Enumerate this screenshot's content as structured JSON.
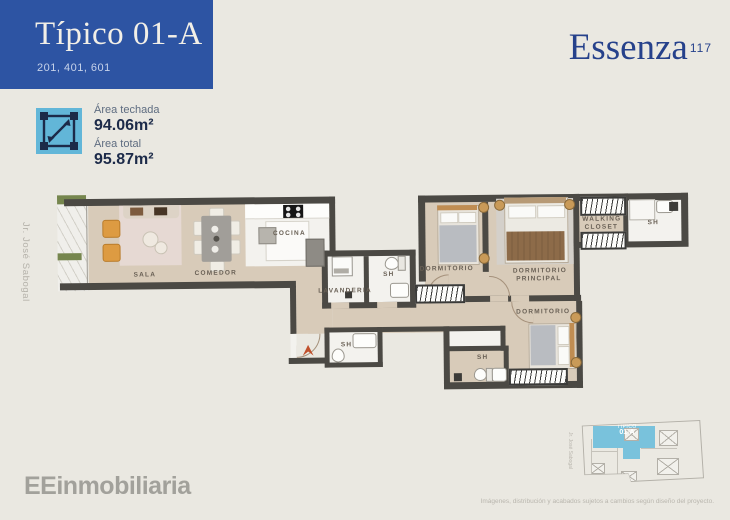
{
  "page": {
    "bg_color": "#eae8e1"
  },
  "header": {
    "title": "Típico 01-A",
    "units": "201, 401, 601",
    "box_color": "#2d54a3"
  },
  "brand": {
    "name": "Essenza",
    "number": "117",
    "color": "#26418b"
  },
  "areas": {
    "covered_label": "Área techada",
    "covered_value": "94.06m²",
    "total_label": "Área total",
    "total_value": "95.87m²",
    "icon": "area-dimensions-icon",
    "icon_color": "#62b6d8"
  },
  "street_label": "Jr. José Sabogal",
  "plan": {
    "wall_color": "#4b4944",
    "floor_color": "#d8cbb9",
    "entrance_arrow_color": "#c0502c",
    "rooms": [
      {
        "id": "sala",
        "label": "SALA"
      },
      {
        "id": "comedor",
        "label": "COMEDOR"
      },
      {
        "id": "cocina",
        "label": "COCINA"
      },
      {
        "id": "lavanderia",
        "label": "LAVANDERIA"
      },
      {
        "id": "sh-hall",
        "label": "SH"
      },
      {
        "id": "dormitorio-1",
        "label": "DORMITORIO"
      },
      {
        "id": "dormitorio-principal",
        "label": "DORMITORIO PRINCIPAL"
      },
      {
        "id": "walking-closet",
        "label": "WALKING CLOSET"
      },
      {
        "id": "sh-principal",
        "label": "SH"
      },
      {
        "id": "dormitorio-2",
        "label": "DORMITORIO"
      },
      {
        "id": "sh-entrada",
        "label": "SH"
      },
      {
        "id": "sh-dormitorio-2",
        "label": "SH"
      }
    ]
  },
  "keyplan": {
    "unit_top": "TÍPICO",
    "unit_bottom": "01-A",
    "street": "Jr. José Sabogal",
    "highlight_color": "#79c2dc"
  },
  "footer": {
    "logo": "EEinmobiliaria",
    "disclaimer": "Imágenes, distribución y acabados sujetos a cambios según diseño del proyecto."
  }
}
